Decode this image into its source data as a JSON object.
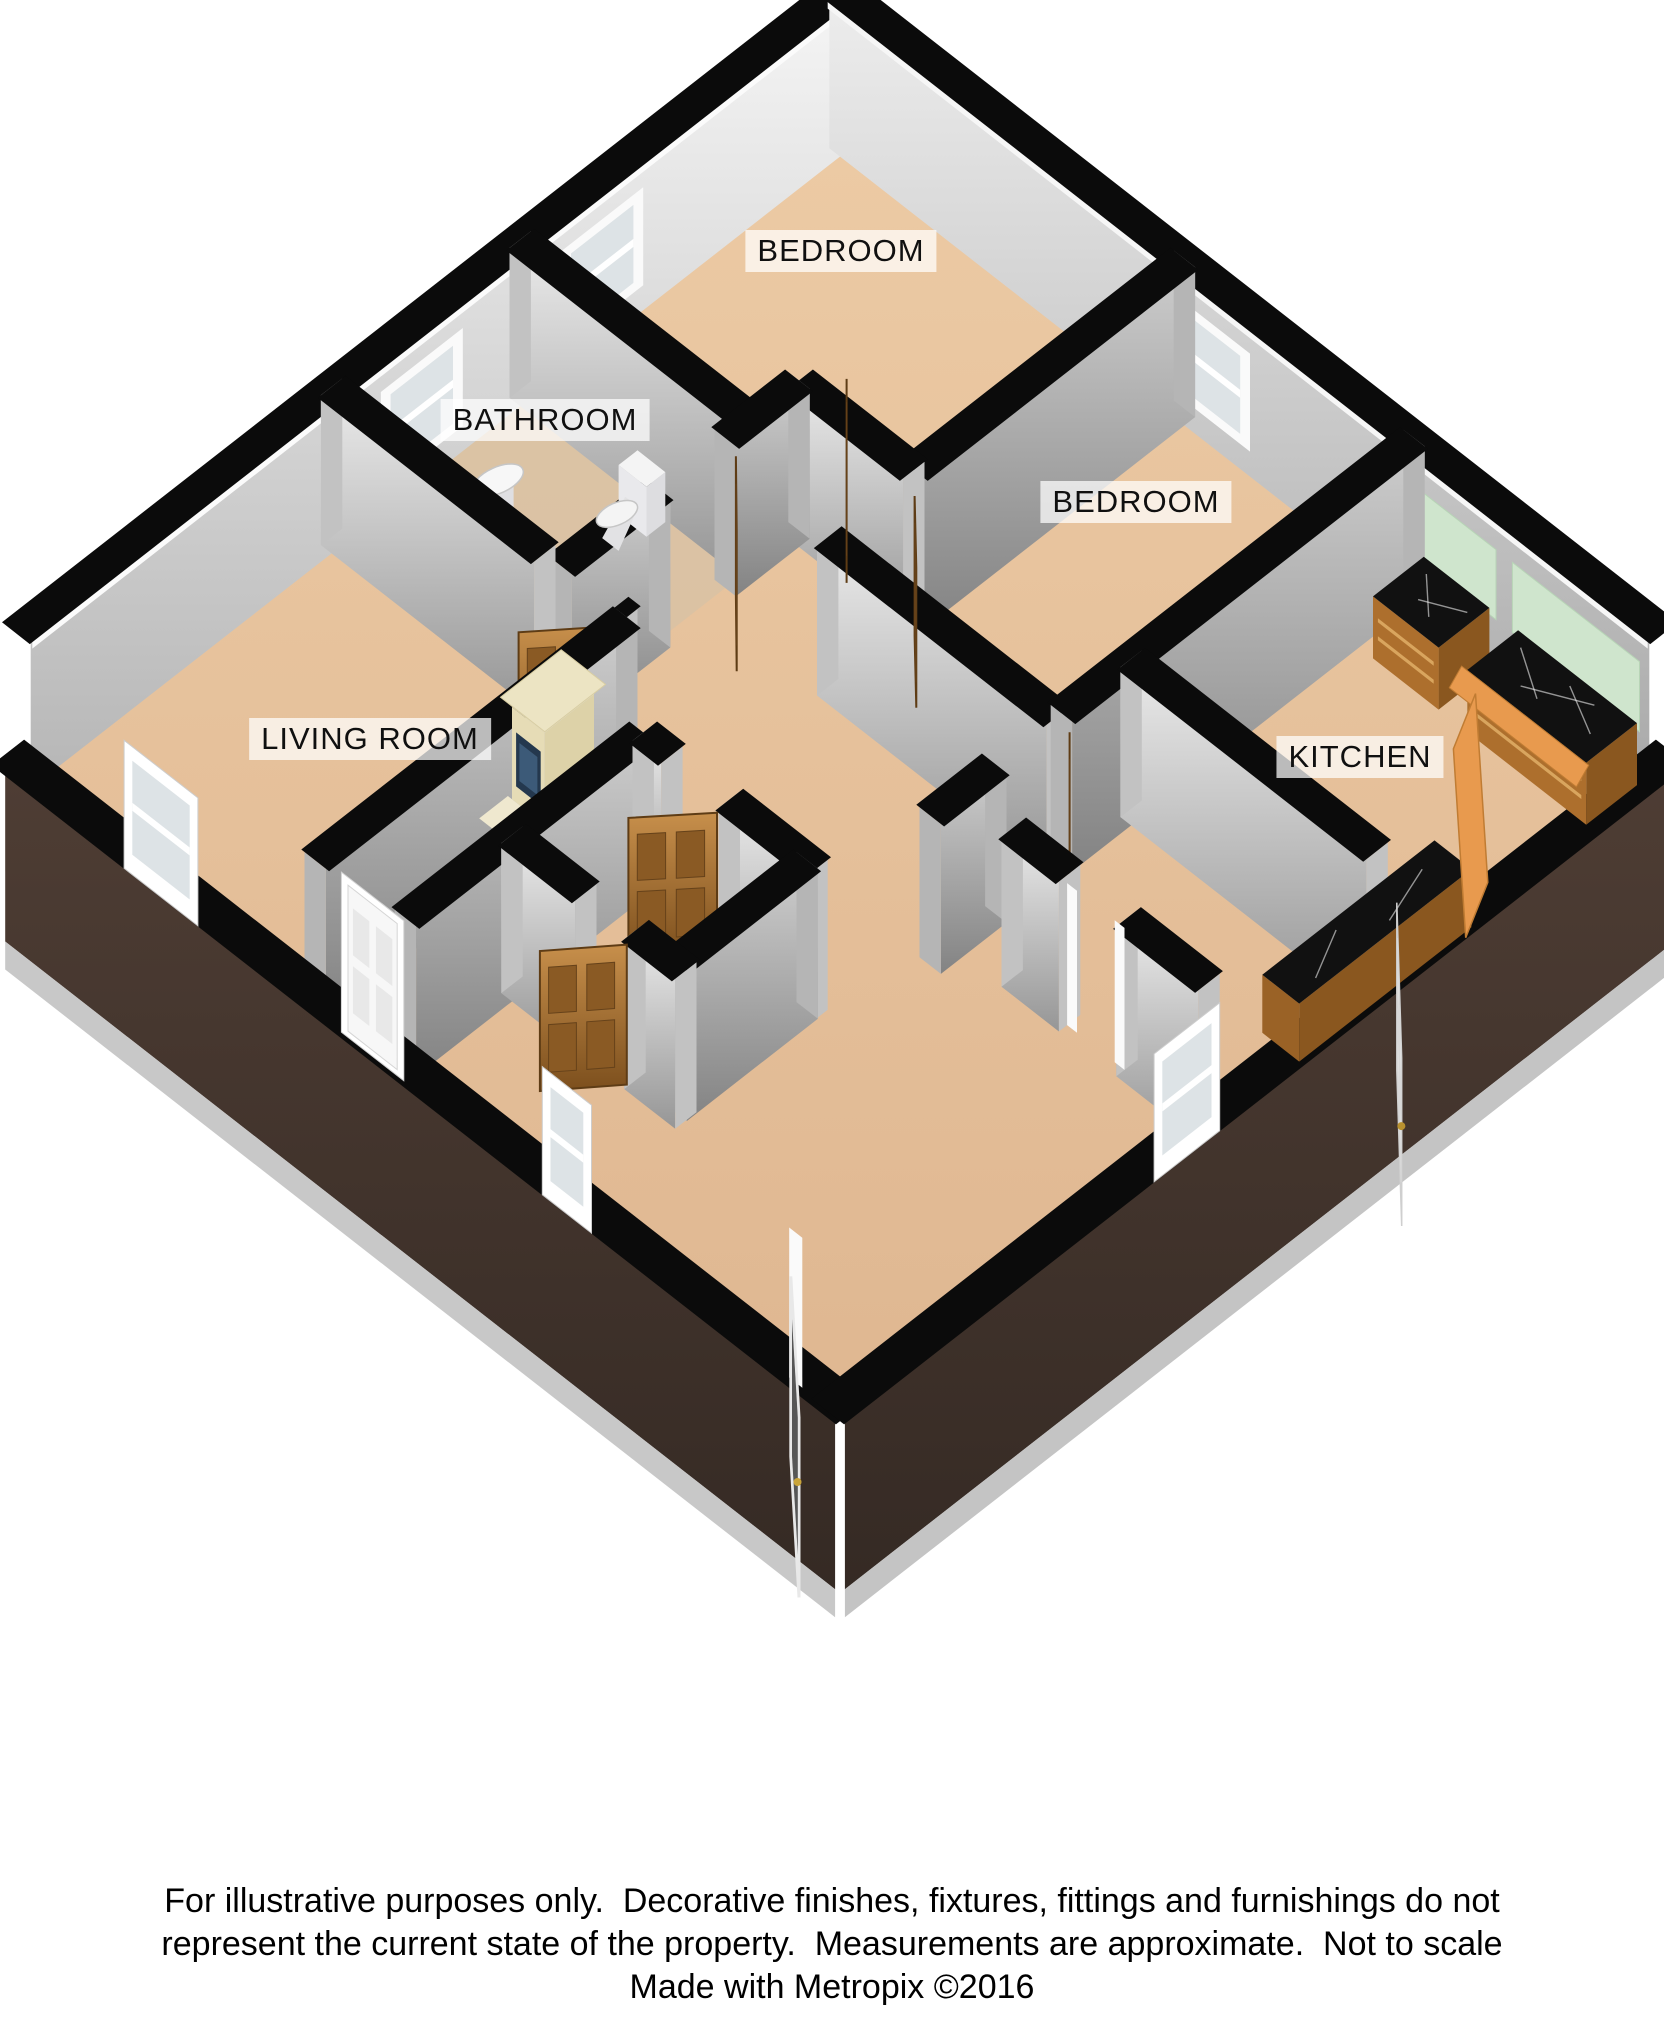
{
  "floorplan": {
    "rooms": [
      {
        "id": "bedroom-top",
        "label": "BEDROOM"
      },
      {
        "id": "bathroom",
        "label": "BATHROOM"
      },
      {
        "id": "bedroom-right",
        "label": "BEDROOM"
      },
      {
        "id": "living-room",
        "label": "LIVING ROOM"
      },
      {
        "id": "kitchen",
        "label": "KITCHEN"
      }
    ],
    "colors": {
      "background": "#ffffff",
      "carpet": "#dfb791",
      "carpet_light": "#eccaa4",
      "bathroom_floor": "#d9c2a4",
      "wall_cap": "#0b0b0b",
      "wall_light": "#efefef",
      "wall_mid": "#b9b9b9",
      "wall_dark": "#8f8f8f",
      "brick": "#4e3d34",
      "brick_dark": "#352a24",
      "door_wood": "#b97f3e",
      "door_wood_dark": "#7c4f1d",
      "white_joinery": "#f7f7f7",
      "glass": "#dde3e6",
      "marble": "#111111",
      "cabinet_wood": "#ad6f2d",
      "worktop_orange": "#e89a4e",
      "splashback": "#cfe5cd",
      "fireplace_cream": "#ece4c3",
      "fireplace_screen": "#24384e"
    }
  },
  "footer": {
    "line1": "For illustrative purposes only.  Decorative finishes, fixtures, fittings and furnishings do not",
    "line2": "represent the current state of the property.  Measurements are approximate.  Not to scale",
    "line3": "Made with Metropix ©2016"
  }
}
